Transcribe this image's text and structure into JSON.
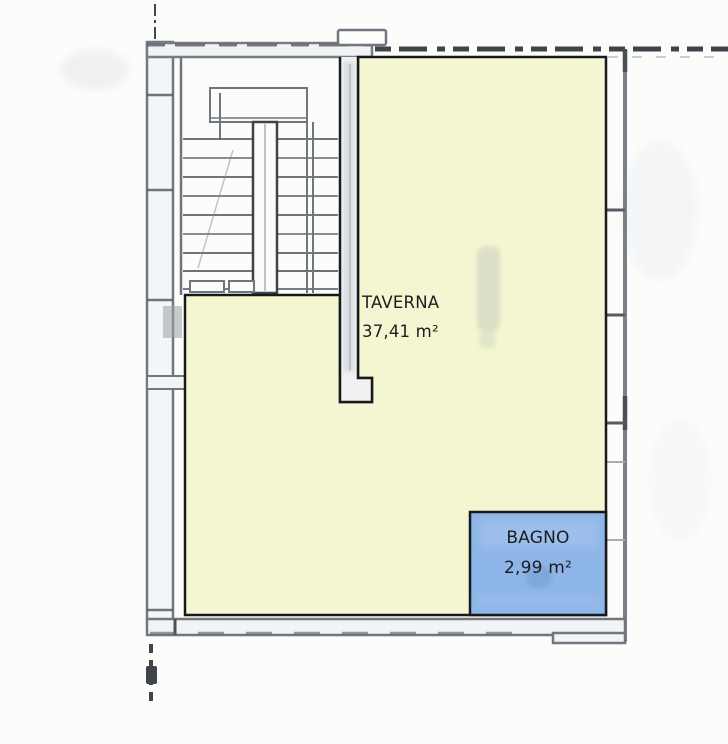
{
  "plan": {
    "rooms": [
      {
        "name": "TAVERNA",
        "area": "37,41 m²",
        "fill": "#f4f6d2"
      },
      {
        "name": "BAGNO",
        "area": "2,99 m²",
        "fill": "#8db5e8"
      }
    ],
    "colors": {
      "background": "#fcfcfb",
      "room_outline": "#17191b",
      "wall_gray": "#767d85",
      "wall_dark": "#41464c",
      "stair_line": "#61686f",
      "watermark": "#c6cabb",
      "label_text": "#1b1d1f",
      "bagno_ghost": "#6e93c4"
    }
  }
}
